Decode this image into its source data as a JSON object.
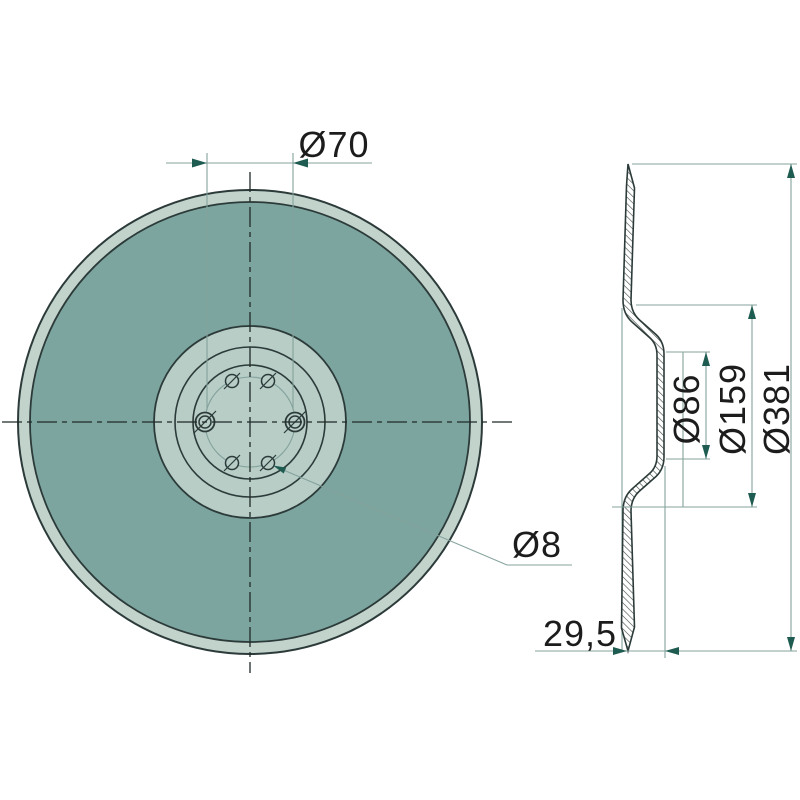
{
  "drawing": {
    "kind": "technical-drawing",
    "views": {
      "front": {
        "name": "front-view-of-disc",
        "dimensions": {
          "bolt_circle": "Ø70",
          "hole": "Ø8"
        }
      },
      "section": {
        "name": "side-section-of-disc",
        "dimensions": {
          "hub_flat": "Ø86",
          "cone": "Ø159",
          "outer": "Ø381",
          "depth": "29,5"
        }
      }
    },
    "colors": {
      "background": "#ffffff",
      "disc_face": "#7da5a0",
      "rim_band": "#c2d3cc",
      "hub_face": "#b7cdc6",
      "outline": "#2c3b39",
      "dimension_lines": "#84a29c",
      "arrowheads": "#1e5b50",
      "text": "#1c1c1c"
    }
  }
}
